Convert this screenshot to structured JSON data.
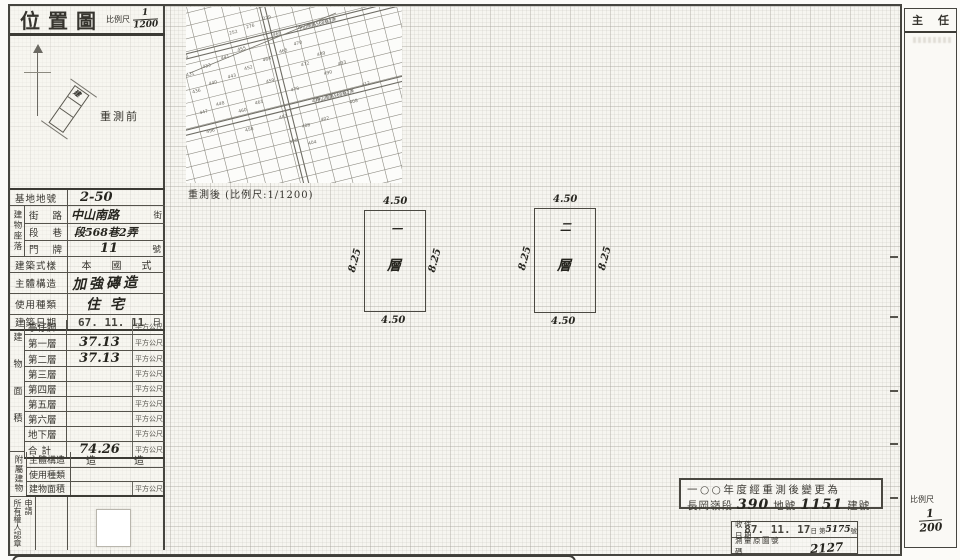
{
  "doc": {
    "title": "位置圖",
    "scale_label": "比例尺",
    "scale_num": "1",
    "scale_den": "1200",
    "before_label": "重測前",
    "after_caption": "重測後 (比例尺:1/1200)"
  },
  "left_table": {
    "site_no": {
      "label": "基地地號",
      "value": "2-50"
    },
    "location_header": "建物座落",
    "street": {
      "l1": "街",
      "l2": "路",
      "value": "中山南路",
      "suffix": "街"
    },
    "lane": {
      "l1": "段",
      "l2": "巷",
      "value": "段568巷2弄"
    },
    "door": {
      "l1": "門",
      "l2": "牌",
      "value": "11",
      "suffix": "號"
    },
    "style": {
      "label": "建築式樣",
      "value": "本國式"
    },
    "structure": {
      "label": "主體構造",
      "value": "加強磚造"
    },
    "usage": {
      "label": "使用種類",
      "value": "住宅"
    },
    "date": {
      "label": "建築日期",
      "value": "67. 11. 11",
      "suffix": "日"
    },
    "area_section": {
      "header": "建物面積",
      "unit": "平方公尺",
      "rows": [
        {
          "label": "亭仔脚",
          "value": ""
        },
        {
          "label": "第一層",
          "value": "37.13"
        },
        {
          "label": "第二層",
          "value": "37.13"
        },
        {
          "label": "第三層",
          "value": ""
        },
        {
          "label": "第四層",
          "value": ""
        },
        {
          "label": "第五層",
          "value": ""
        },
        {
          "label": "第六層",
          "value": ""
        },
        {
          "label": "地下層",
          "value": ""
        },
        {
          "label": "合計",
          "value": "74.26"
        }
      ]
    },
    "annex": {
      "header": "附屬建物",
      "row1": {
        "label": "主體構造",
        "value": "造　　造"
      },
      "row2": {
        "label": "使用種類",
        "value": ""
      },
      "row3": {
        "label": "建物面積",
        "value": "",
        "unit": "平方公尺"
      }
    },
    "seal": {
      "right": "申請",
      "left": "所有權人認章"
    }
  },
  "plans": {
    "floor1": {
      "top": "4.50",
      "bottom": "4.50",
      "left": "8.25",
      "right": "8.25",
      "num": "一",
      "floor": "層"
    },
    "floor2": {
      "top": "4.50",
      "bottom": "4.50",
      "left": "8.25",
      "right": "8.25",
      "num": "二",
      "floor": "層"
    }
  },
  "stamp_box": {
    "line1": "一○○年度經重測後變更為",
    "seg": "長岡嶺段",
    "land_no": "390",
    "mid": "地號",
    "bldg_no": "1151",
    "end": "建號"
  },
  "receipt": {
    "r1_label": "收件日期",
    "r1_date": "87. 11. 17",
    "r1_day": "日",
    "r1_no_prefix": "第",
    "r1_no": "5175",
    "r1_no_suffix": "號",
    "r2_label": "測量原圖號碼",
    "r2_value": "2127"
  },
  "director": {
    "t1": "主",
    "t2": "任",
    "scale_label": "比例尺",
    "num": "1",
    "den": "200"
  },
  "inset_map": {
    "street_label1": "中山南路568巷2弄",
    "street_label2": "中山南路568巷2弄",
    "numbers": [
      {
        "t": "426",
        "x": 6,
        "y": 26
      },
      {
        "t": "431",
        "x": 8,
        "y": 44
      },
      {
        "t": "433",
        "x": 26,
        "y": 40
      },
      {
        "t": "436",
        "x": 10,
        "y": 62
      },
      {
        "t": "440",
        "x": 28,
        "y": 58
      },
      {
        "t": "447",
        "x": 12,
        "y": 84
      },
      {
        "t": "448",
        "x": 30,
        "y": 80
      },
      {
        "t": "496",
        "x": 14,
        "y": 104
      },
      {
        "t": "443",
        "x": 48,
        "y": 56
      },
      {
        "t": "441",
        "x": 46,
        "y": 36
      },
      {
        "t": "455",
        "x": 64,
        "y": 32
      },
      {
        "t": "452",
        "x": 66,
        "y": 52
      },
      {
        "t": "460",
        "x": 50,
        "y": 92
      },
      {
        "t": "461",
        "x": 68,
        "y": 88
      },
      {
        "t": "458",
        "x": 52,
        "y": 112
      },
      {
        "t": "459",
        "x": 84,
        "y": 70
      },
      {
        "t": "464",
        "x": 86,
        "y": 48
      },
      {
        "t": "465",
        "x": 104,
        "y": 44
      },
      {
        "t": "468",
        "x": 102,
        "y": 26
      },
      {
        "t": "470",
        "x": 120,
        "y": 40
      },
      {
        "t": "472",
        "x": 122,
        "y": 62
      },
      {
        "t": "478",
        "x": 106,
        "y": 84
      },
      {
        "t": "479",
        "x": 124,
        "y": 100
      },
      {
        "t": "483",
        "x": 88,
        "y": 108
      },
      {
        "t": "488",
        "x": 108,
        "y": 122
      },
      {
        "t": "489",
        "x": 140,
        "y": 56
      },
      {
        "t": "490",
        "x": 142,
        "y": 76
      },
      {
        "t": "493",
        "x": 158,
        "y": 70
      },
      {
        "t": "412",
        "x": 176,
        "y": 96
      },
      {
        "t": "408",
        "x": 160,
        "y": 110
      },
      {
        "t": "402",
        "x": 128,
        "y": 120
      },
      {
        "t": "404",
        "x": 110,
        "y": 140
      },
      {
        "t": "398",
        "x": 92,
        "y": 134
      },
      {
        "t": "279",
        "x": 96,
        "y": 8
      },
      {
        "t": "276",
        "x": 78,
        "y": 12
      },
      {
        "t": "252",
        "x": 60,
        "y": 14
      }
    ]
  }
}
